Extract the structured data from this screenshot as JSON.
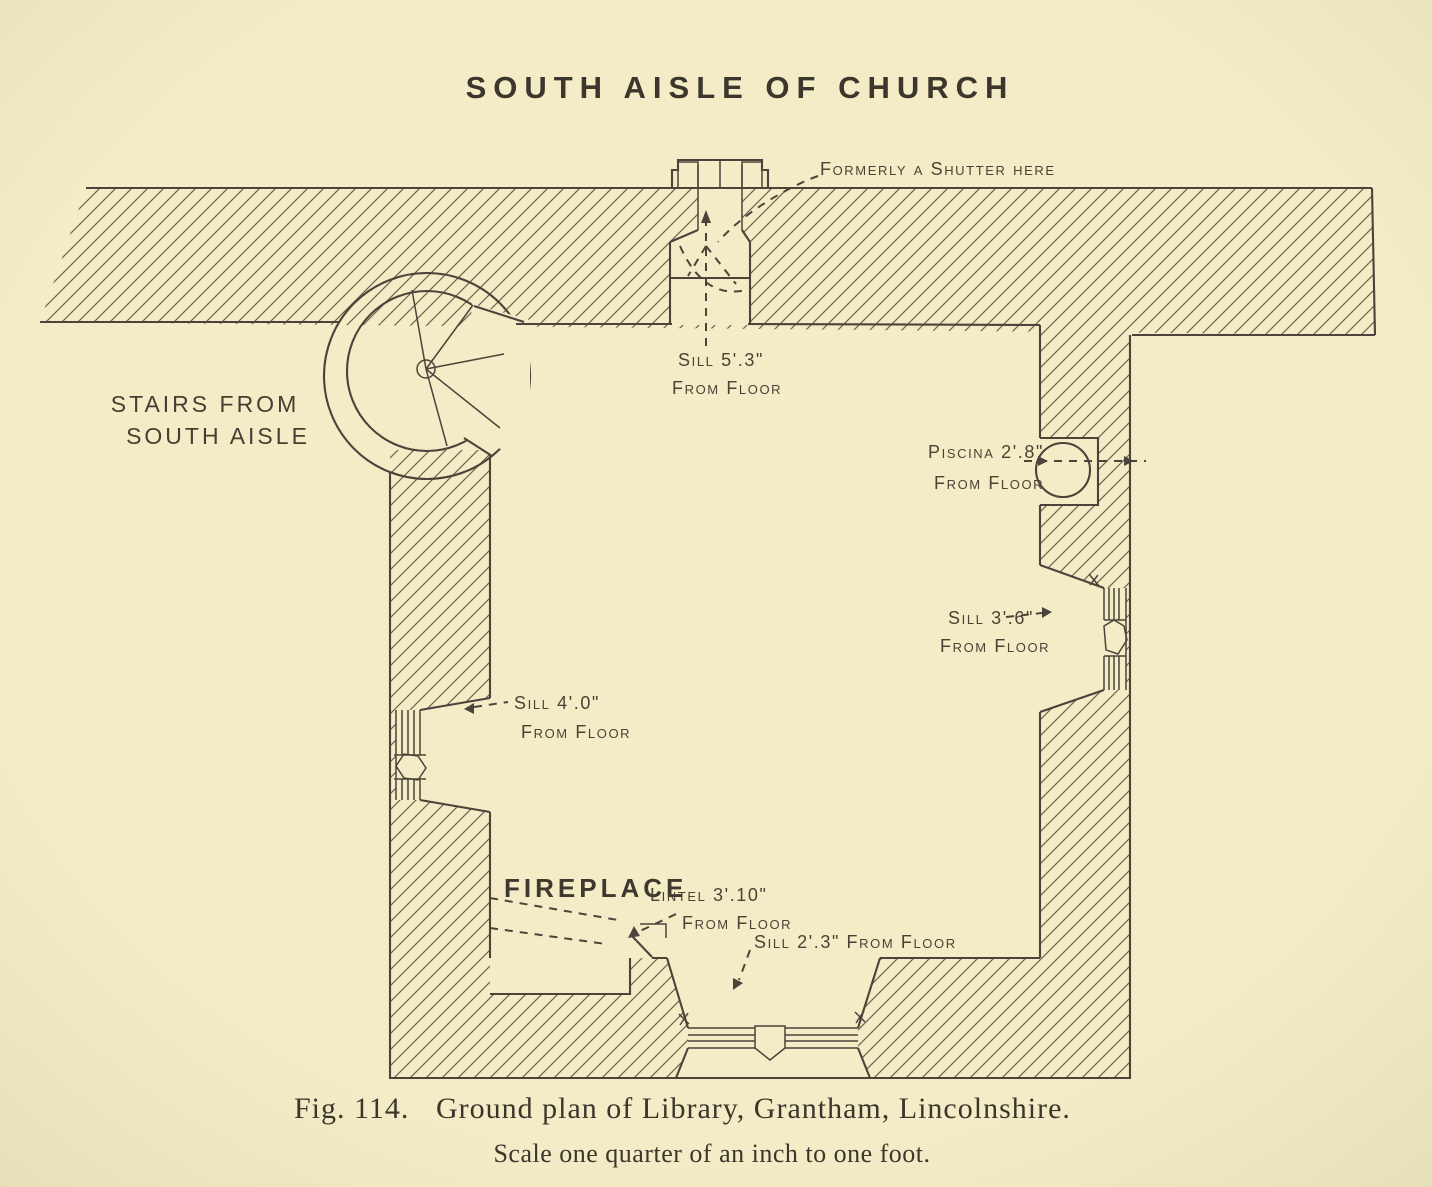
{
  "figure": {
    "title": "SOUTH AISLE OF CHURCH",
    "labels": {
      "stairs_line1": "STAIRS FROM",
      "stairs_line2": "SOUTH AISLE",
      "shutter": "Formerly a Shutter here",
      "sill_north_1": "Sill 5'.3\"",
      "sill_north_2": "From Floor",
      "piscina_1": "Piscina 2'.8\"",
      "piscina_2": "From Floor",
      "sill_east_1": "Sill 3'.6\"",
      "sill_east_2": "From Floor",
      "sill_west_1": "Sill 4'.0\"",
      "sill_west_2": "From Floor",
      "fireplace": "FIREPLACE",
      "lintel_1": "Lintel 3'.10\"",
      "lintel_2": "From Floor",
      "sill_south": "Sill 2'.3\" From Floor"
    },
    "caption": {
      "fig_number": "Fig. 114.",
      "text": "Ground plan of Library, Grantham, Lincolnshire.",
      "scale": "Scale one quarter of an inch to one foot."
    },
    "colors": {
      "paper": "#f3ecc6",
      "ink": "#4a443a",
      "hatch": "#73644e"
    }
  }
}
